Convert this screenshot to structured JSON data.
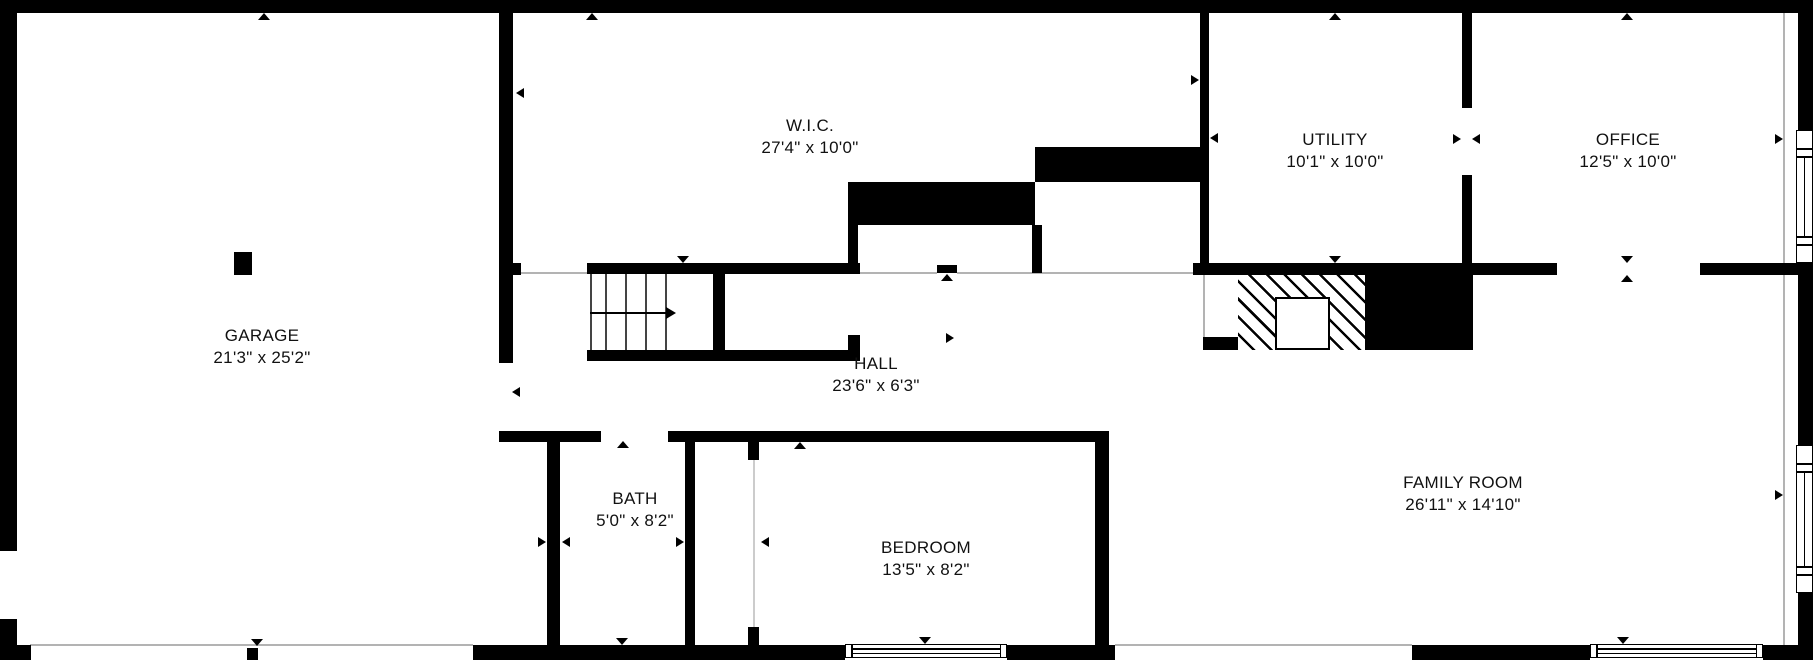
{
  "colors": {
    "wall": "#000000",
    "background": "#ffffff",
    "thin_line": "#b3b3b3",
    "door_gap_line": "#cccccc",
    "text": "#111111"
  },
  "rooms": {
    "garage": {
      "label": "GARAGE",
      "dims": "21'3\" x 25'2\"",
      "cx": 262,
      "cy": 347
    },
    "wic": {
      "label": "W.I.C.",
      "dims": "27'4\" x 10'0\"",
      "cx": 810,
      "cy": 137
    },
    "utility": {
      "label": "UTILITY",
      "dims": "10'1\" x 10'0\"",
      "cx": 1335,
      "cy": 151
    },
    "office": {
      "label": "OFFICE",
      "dims": "12'5\" x 10'0\"",
      "cx": 1628,
      "cy": 151
    },
    "hall": {
      "label": "HALL",
      "dims": "23'6\" x 6'3\"",
      "cx": 876,
      "cy": 375
    },
    "bath": {
      "label": "BATH",
      "dims": "5'0\" x 8'2\"",
      "cx": 635,
      "cy": 510
    },
    "bedroom": {
      "label": "BEDROOM",
      "dims": "13'5\" x 8'2\"",
      "cx": 926,
      "cy": 559
    },
    "family_room": {
      "label": "FAMILY ROOM",
      "dims": "26'11\" x 14'10\"",
      "cx": 1463,
      "cy": 494
    }
  },
  "plan": {
    "walls": [
      [
        0,
        0,
        1813,
        13
      ],
      [
        0,
        0,
        17,
        551
      ],
      [
        0,
        619,
        17,
        41
      ],
      [
        17,
        645,
        14,
        15
      ],
      [
        1798,
        0,
        15,
        130
      ],
      [
        1798,
        263,
        15,
        182
      ],
      [
        1798,
        593,
        15,
        67
      ],
      [
        473,
        645,
        372,
        15
      ],
      [
        1007,
        645,
        108,
        15
      ],
      [
        1412,
        645,
        178,
        15
      ],
      [
        1763,
        645,
        50,
        15
      ],
      [
        499,
        13,
        14,
        350
      ],
      [
        513,
        263,
        8,
        12
      ],
      [
        234,
        252,
        18,
        23
      ],
      [
        587,
        263,
        273,
        11
      ],
      [
        713,
        274,
        12,
        76
      ],
      [
        587,
        350,
        273,
        11
      ],
      [
        848,
        335,
        12,
        15
      ],
      [
        937,
        265,
        20,
        8
      ],
      [
        848,
        225,
        10,
        38
      ],
      [
        1032,
        225,
        10,
        48
      ],
      [
        848,
        182,
        187,
        43
      ],
      [
        1035,
        147,
        174,
        35
      ],
      [
        1200,
        13,
        9,
        250
      ],
      [
        1193,
        263,
        279,
        12
      ],
      [
        1462,
        13,
        10,
        95
      ],
      [
        1462,
        175,
        10,
        88
      ],
      [
        1472,
        263,
        85,
        12
      ],
      [
        1700,
        263,
        98,
        12
      ],
      [
        499,
        431,
        102,
        11
      ],
      [
        547,
        441,
        13,
        206
      ],
      [
        668,
        431,
        440,
        11
      ],
      [
        685,
        441,
        10,
        206
      ],
      [
        748,
        441,
        11,
        19
      ],
      [
        748,
        627,
        11,
        20
      ],
      [
        1095,
        431,
        14,
        229
      ],
      [
        247,
        648,
        11,
        12
      ],
      [
        1365,
        272,
        108,
        78
      ],
      [
        1203,
        337,
        35,
        13
      ]
    ],
    "thin_lines": [
      [
        519,
        272,
        68,
        2
      ],
      [
        860,
        272,
        77,
        2
      ],
      [
        957,
        272,
        236,
        2
      ],
      [
        30,
        644,
        443,
        2
      ],
      [
        1115,
        644,
        297,
        2
      ],
      [
        1783,
        13,
        2,
        632
      ],
      [
        1203,
        275,
        2,
        62
      ]
    ],
    "door_gap_lines": [
      [
        753,
        460,
        2,
        167
      ]
    ],
    "stairs": {
      "treads_x": [
        590,
        605,
        625,
        645,
        665
      ],
      "tread_y": 274,
      "tread_h": 76,
      "arrow_line": [
        590,
        312,
        80,
        2
      ],
      "arrow_head": [
        676,
        313
      ]
    },
    "fireplace": {
      "hatch": [
        1238,
        272,
        127,
        78
      ],
      "insert": [
        1275,
        297,
        55,
        53
      ]
    },
    "windows": [
      {
        "o": "v",
        "x": 1796,
        "y": 130,
        "w": 17,
        "h": 133
      },
      {
        "o": "v",
        "x": 1796,
        "y": 445,
        "w": 17,
        "h": 148
      },
      {
        "o": "h",
        "x": 845,
        "y": 644,
        "w": 162,
        "h": 14
      },
      {
        "o": "h",
        "x": 1590,
        "y": 644,
        "w": 173,
        "h": 14
      }
    ],
    "markers": [
      [
        264,
        13,
        "up",
        12,
        7
      ],
      [
        592,
        13,
        "up",
        12,
        7
      ],
      [
        1335,
        13,
        "up",
        12,
        7
      ],
      [
        1627,
        13,
        "up",
        12,
        7
      ],
      [
        683,
        263,
        "down",
        12,
        7
      ],
      [
        1335,
        263,
        "down",
        12,
        7
      ],
      [
        1627,
        263,
        "down",
        12,
        7
      ],
      [
        1627,
        275,
        "up",
        12,
        7
      ],
      [
        947,
        274,
        "up",
        12,
        7
      ],
      [
        623,
        441,
        "up",
        12,
        7
      ],
      [
        800,
        442,
        "up",
        12,
        7
      ],
      [
        622,
        645,
        "down",
        12,
        7
      ],
      [
        925,
        644,
        "down",
        12,
        7
      ],
      [
        1623,
        644,
        "down",
        12,
        7
      ],
      [
        257,
        646,
        "down",
        12,
        7
      ],
      [
        516,
        93,
        "left",
        8,
        11
      ],
      [
        1199,
        80,
        "right",
        8,
        11
      ],
      [
        1210,
        138,
        "left",
        8,
        11
      ],
      [
        1461,
        139,
        "right",
        8,
        11
      ],
      [
        1472,
        139,
        "left",
        8,
        11
      ],
      [
        1783,
        139,
        "right",
        8,
        11
      ],
      [
        954,
        338,
        "right",
        8,
        11
      ],
      [
        512,
        392,
        "left",
        8,
        11
      ],
      [
        9,
        544,
        "left",
        8,
        11
      ],
      [
        546,
        542,
        "right",
        8,
        11
      ],
      [
        562,
        542,
        "left",
        8,
        11
      ],
      [
        684,
        542,
        "right",
        8,
        11
      ],
      [
        761,
        542,
        "left",
        8,
        11
      ],
      [
        1783,
        495,
        "right",
        8,
        11
      ]
    ]
  }
}
